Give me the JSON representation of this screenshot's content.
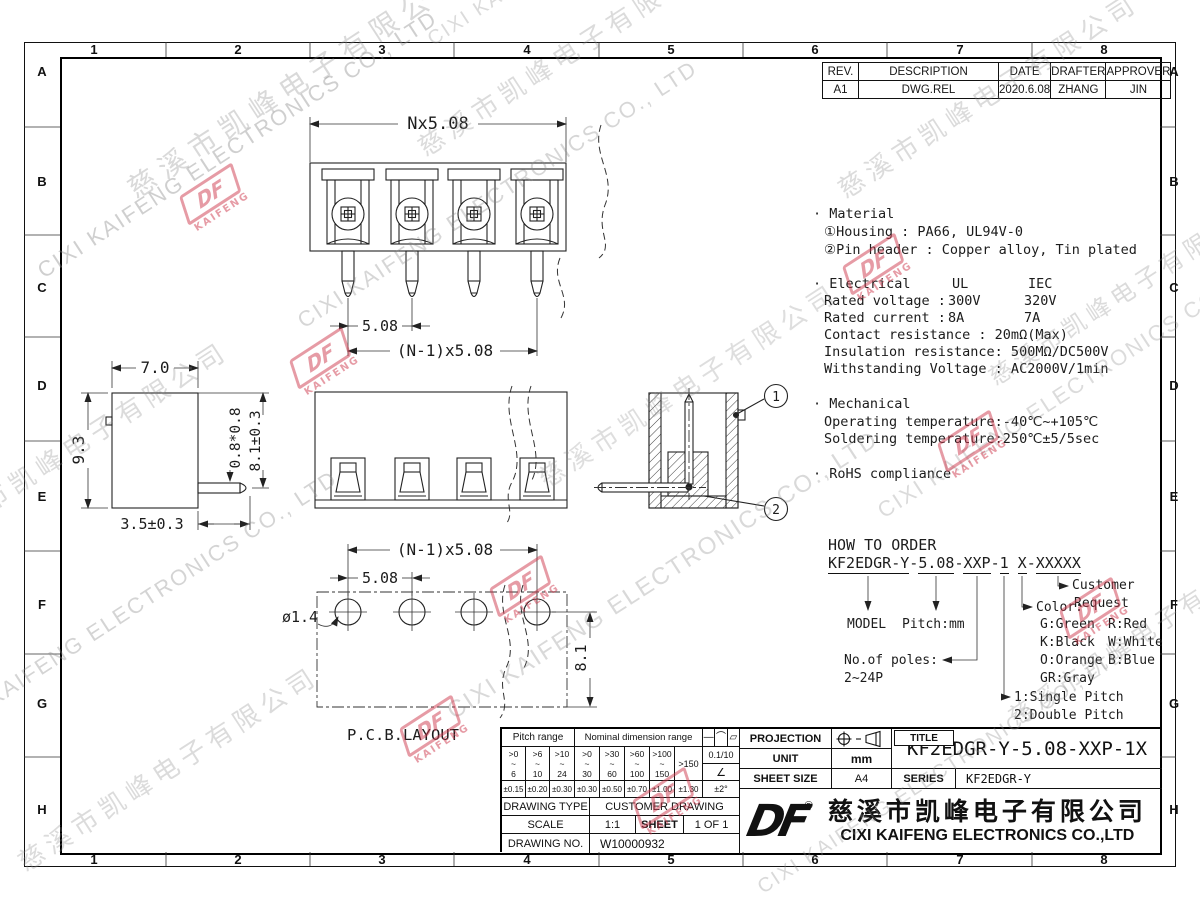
{
  "border": {
    "cols": [
      "1",
      "2",
      "3",
      "4",
      "5",
      "6",
      "7",
      "8"
    ],
    "rows": [
      "A",
      "B",
      "C",
      "D",
      "E",
      "F",
      "G",
      "H"
    ]
  },
  "revision": {
    "headers": [
      "REV.",
      "DESCRIPTION",
      "DATE",
      "DRAFTER",
      "APPROVER"
    ],
    "row": [
      "A1",
      "DWG.REL",
      "2020.6.08",
      "ZHANG",
      "JIN"
    ]
  },
  "notes": {
    "material_title": "· Material",
    "material_1": "①Housing : PA66, UL94V-0",
    "material_2": "②Pin header : Copper alloy, Tin plated",
    "electrical_title": "· Electrical",
    "elec_col1": "UL",
    "elec_col2": "IEC",
    "rated_voltage_label": "Rated voltage :",
    "rated_voltage_ul": "300V",
    "rated_voltage_iec": "320V",
    "rated_current_label": "Rated current :",
    "rated_current_ul": "8A",
    "rated_current_iec": "7A",
    "contact": "Contact resistance : 20mΩ(Max)",
    "insulation": "Insulation resistance: 500MΩ/DC500V",
    "withstanding": "Withstanding Voltage : AC2000V/1min",
    "mechanical_title": "· Mechanical",
    "operating": "Operating temperature:-40℃~+105℃",
    "soldering": "Soldering temperature:250℃±5/5sec",
    "rohs": "· RoHS compliance"
  },
  "dims": {
    "pitch_total": "Nx5.08",
    "pitch": "5.08",
    "pitch_n1": "(N-1)x5.08",
    "width": "7.0",
    "height": "9.3",
    "pin_square": "0.8*0.8",
    "pin_len": "8.1±0.3",
    "pin_offset": "3.5±0.3",
    "pcb_pitch_n1": "(N-1)x5.08",
    "pcb_pitch": "5.08",
    "hole_dia": "ø1.4",
    "row_dist": "8.1",
    "pcb_label": "P.C.B.LAYOUT",
    "callout_1": "1",
    "callout_2": "2"
  },
  "order": {
    "title": "HOW TO ORDER",
    "sep": "-",
    "space": " ",
    "parts": [
      "KF2EDGR-Y",
      "5.08",
      "XXP",
      "1",
      "X",
      "XXXXX"
    ],
    "model": "MODEL",
    "pitch": "Pitch:mm",
    "poles_1": "No.of poles:",
    "poles_2": "2~24P",
    "color_title": "Color:",
    "colors": [
      [
        "G:Green",
        "R:Red"
      ],
      [
        "K:Black",
        "W:White"
      ],
      [
        "O:Orange",
        "B:Blue"
      ],
      [
        "GR:Gray",
        ""
      ]
    ],
    "type_1": "1:Single Pitch",
    "type_2": "2:Double Pitch",
    "customer_1": "Customer",
    "customer_2": "Request"
  },
  "titleblock": {
    "tol": {
      "pitch_hdr": "Pitch range",
      "nominal_hdr": "Nominal dimension range",
      "sym1": "—",
      "sym2": "⌒",
      "sym3": "▱",
      "tilde": "~",
      "ranges": [
        {
          "a": ">0",
          "b": "6"
        },
        {
          "a": ">6",
          "b": "10"
        },
        {
          "a": ">10",
          "b": "24"
        },
        {
          "a": ">0",
          "b": "30"
        },
        {
          "a": ">30",
          "b": "60"
        },
        {
          "a": ">60",
          "b": "100"
        },
        {
          "a": ">100",
          "b": "150"
        }
      ],
      "over": ">150",
      "flat": "0.1/10",
      "angle_sym": "∠",
      "angle_tol": "±2°",
      "tols": [
        "±0.15",
        "±0.20",
        "±0.30",
        "±0.30",
        "±0.50",
        "±0.70",
        "±1.00",
        "±1.30"
      ]
    },
    "drawing_type_label": "DRAWING TYPE",
    "drawing_type": "CUSTOMER DRAWING",
    "scale_label": "SCALE",
    "scale": "1:1",
    "sheet_label": "SHEET",
    "sheet": "1 OF 1",
    "drawing_no_label": "DRAWING NO.",
    "drawing_no": "W10000932",
    "projection_label": "PROJECTION",
    "unit_label": "UNIT",
    "unit": "mm",
    "sheet_size_label": "SHEET SIZE",
    "sheet_size": "A4",
    "title_label": "TITLE",
    "title": "KF2EDGR-Y-5.08-XXP-1X",
    "series_label": "SERIES",
    "series": "KF2EDGR-Y",
    "logo": "DF",
    "reg": "®",
    "company_zh": "慈溪市凯峰电子有限公司",
    "company_en": "CIXI KAIFENG ELECTRONICS CO.,LTD"
  },
  "watermark": {
    "en": "CIXI KAIFENG ELECTRONICS CO., LTD",
    "zh": "慈溪市凯峰电子有限公司",
    "logo": "DF",
    "logo_sub": "KAIFENG"
  }
}
